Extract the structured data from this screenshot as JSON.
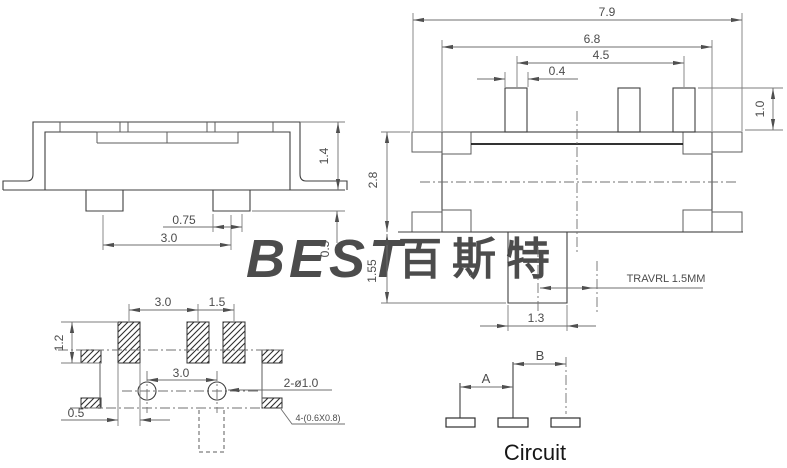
{
  "watermark": {
    "latin": "BEST",
    "cjk": "百斯特",
    "color": "#cfe3f6"
  },
  "side_view": {
    "dims": {
      "body_height": "1.4",
      "peg_width": "0.75",
      "peg_pitch": "3.0",
      "peg_height": "0.5"
    }
  },
  "top_view": {
    "dims": {
      "overall_width": "7.9",
      "body_width": "6.8",
      "pin_span": "4.5",
      "pin_width": "0.4",
      "pin_height": "1.0",
      "body_depth": "2.8",
      "knob_depth": "1.55",
      "knob_width": "1.3"
    },
    "travel_note": "TRAVRL 1.5MM"
  },
  "footprint_view": {
    "dims": {
      "pad_pitch_a": "3.0",
      "pad_pitch_b": "1.5",
      "pad_height": "1.2",
      "hole_pitch": "3.0",
      "pad_width": "0.5"
    },
    "callouts": {
      "holes": "2-ø1.0",
      "side_pads": "4-(0.6X0.8)"
    }
  },
  "circuit_view": {
    "dim_a": "A",
    "dim_b": "B",
    "title": "Circuit"
  }
}
